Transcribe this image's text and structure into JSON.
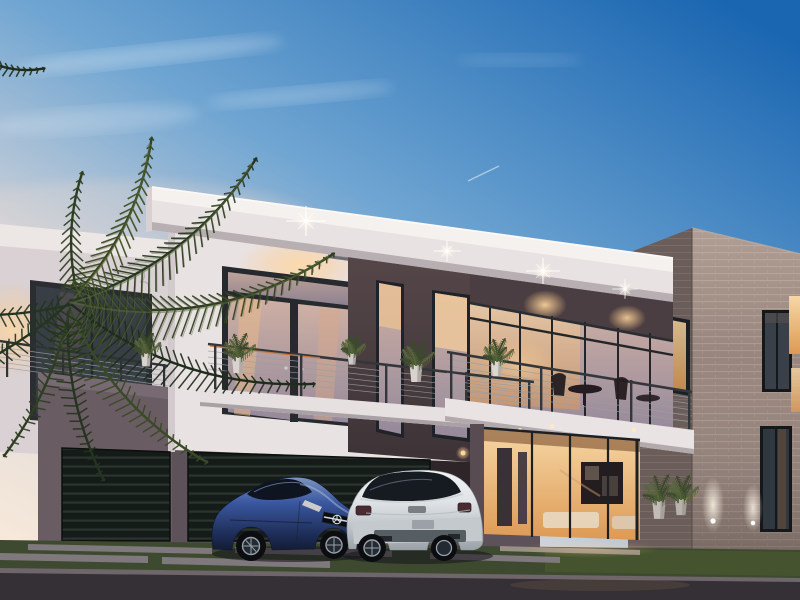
{
  "meta": {
    "description": "Photorealistic dusk rendering of a modern two-story flat-roof villa with glass curtain walls, cable-rail balconies, brick end volume, two garage doors, a blue Mercedes sports coupe and a white BMW crossover parked on the street, and a large palm tree at left",
    "time_of_day": "dusk",
    "style": "contemporary architecture 3D render"
  },
  "scene": {
    "sky": {
      "condition": "clear dusk with thin wispy clouds and a faint contrail"
    },
    "building": {
      "stories": 2,
      "left_wing": "white stucco volume with dark-framed french doors and cable-rail balcony with potted plants",
      "center": "dark taupe accent panel with two tall slot windows flanked by mini balconies",
      "main_balcony": "long white slab balcony with steel cable railing, bistro table and chairs, potted plant",
      "ground_floor": "full-height glass entrance glowing warm with framed artwork and lounge furniture inside",
      "right_wing": "gray-brown brick volume with slot windows and ground uplights",
      "garage_doors": 2,
      "garage_style": "dark horizontal-slat panels",
      "lights": "starburst soffit downlights along the roof fascia and balcony soffits"
    },
    "vehicles": [
      {
        "type": "sports coupe",
        "brand_mark": "Mercedes three-point star grille",
        "color": "metallic blue",
        "view": "front three-quarter, nose to the right"
      },
      {
        "type": "luxury crossover",
        "brand_mark": "BMW-style tailgate",
        "color": "white-silver",
        "view": "rear three-quarter"
      }
    ],
    "vegetation": {
      "palm_tree": "large feathered palm fronds overhanging from the left",
      "potted_plants": 7,
      "lawn": "dark green strips between paver walkway and asphalt street"
    },
    "ground": {
      "walkway": "long light concrete pavers with grass joints",
      "street": "dark asphalt at dusk"
    }
  },
  "palette": {
    "sky_top": "#1a66b1",
    "sky_mid": "#6fa5d2",
    "sky_low": "#dcd8da",
    "sky_horizon": "#f6e8da",
    "wall_white": "#e9e2e2",
    "fascia_top": "#f5f1ef",
    "accent_dark": "#564749",
    "accent_dark2": "#3d3337",
    "mauve_wall": "#6a5c63",
    "garage_base": "#141b18",
    "garage_slat": "#2b342f",
    "brick_front": "#93817a",
    "brick_light": "#a5948c",
    "brick_shadow": "#6b5e5a",
    "glass_warm_hi": "#f6d7a5",
    "glass_warm_lo": "#dd9a55",
    "glass_dusk_hi": "#cfb0a4",
    "glass_dusk_lo": "#96899b",
    "interior_warm": "#eec187",
    "grass": "#3d4a2f",
    "paver": "#7f787d",
    "road": "#343035",
    "curb": "#6e666a",
    "palm_dark": "#253420",
    "car_blue_hi": "#7d93c0",
    "car_blue": "#3a57a0",
    "car_blue_dark": "#131c36",
    "car_white": "#dfe3e6",
    "light_warm": "#ffd8a0",
    "light_bright": "#fff6e8"
  }
}
